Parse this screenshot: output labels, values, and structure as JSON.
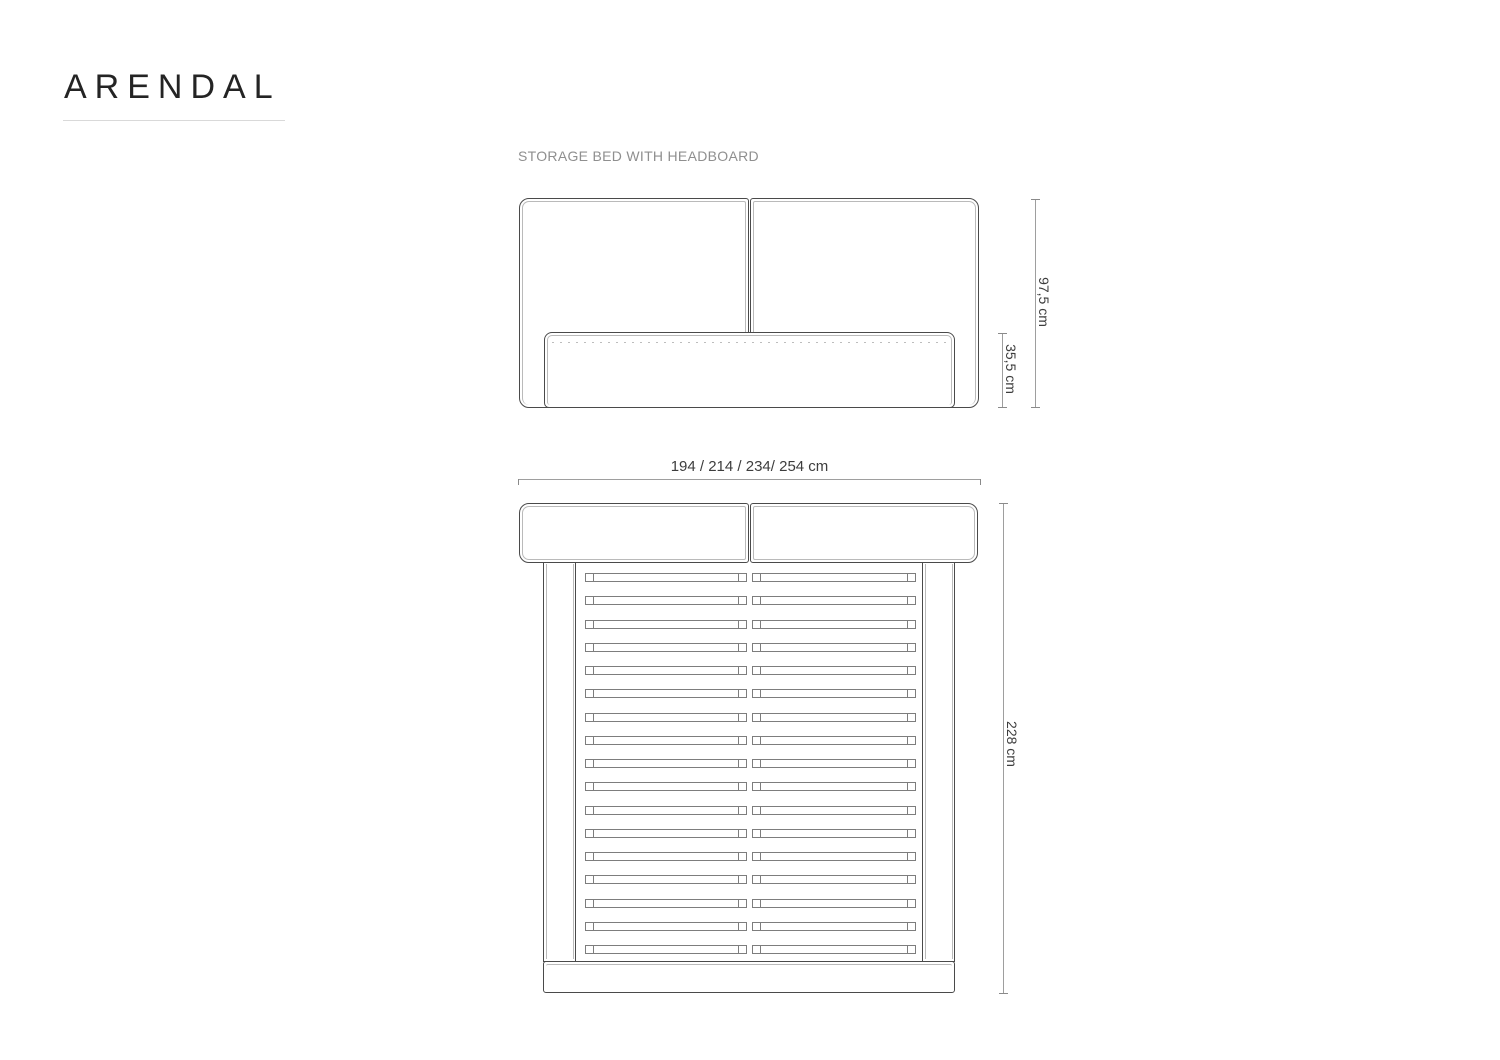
{
  "header": {
    "title": "ARENDAL",
    "subtitle": "STORAGE BED WITH HEADBOARD"
  },
  "dimensions": {
    "front_total_height": "97,5 cm",
    "front_base_height": "35,5 cm",
    "top_width_options": "194 / 214 / 234/ 254 cm",
    "top_length": "228 cm"
  },
  "structure": {
    "slat_rows": 17,
    "slats_per_row": 2
  },
  "colors": {
    "outline": "#4a4a4a",
    "inner_line": "#bababa",
    "dimension_line": "#9e9e9e",
    "dimension_text": "#3d3d3d",
    "title_text": "#242424",
    "subtitle_text": "#8f8f8f"
  }
}
